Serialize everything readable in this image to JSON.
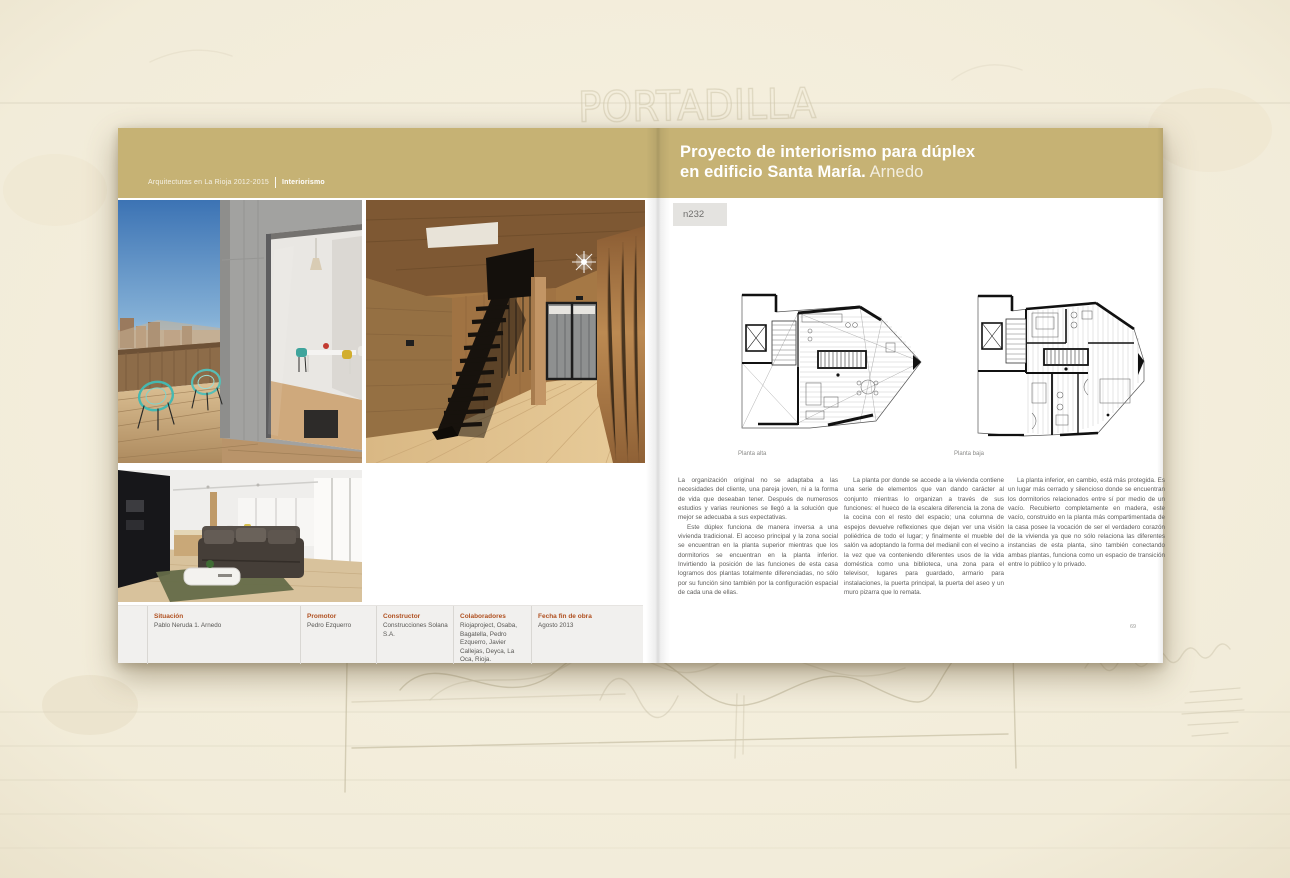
{
  "book": {
    "series_title": "Arquitecturas en La Rioja 2012-2015",
    "section": "Interiorismo",
    "project_title_line1": "Proyecto de interiorismo para dúplex",
    "project_title_line2": "en edificio Santa María.",
    "project_location": " Arnedo",
    "project_code": "n232",
    "page_number": "69"
  },
  "plans": {
    "left_caption": "Planta alta",
    "right_caption": "Planta baja"
  },
  "body": {
    "col1_p1": "La organización original no se adaptaba a las necesidades del cliente, una pareja joven, ni a la forma de vida que deseaban tener. Después de numerosos estudios y varias reuniones se llegó a la solución que mejor se adecuaba a sus expectativas.",
    "col1_p2": "Este dúplex funciona de manera inversa a una vivienda tradicional. El acceso principal y la zona social se encuentran en la planta superior mientras que los dormitorios se encuentran en la planta inferior. Invirtiendo la posición de las funciones de esta casa logramos dos plantas totalmente diferenciadas, no sólo por su función sino también por la configuración espacial de cada una de ellas.",
    "col2_p1": "La planta por donde se accede a la vivienda contiene una serie de elementos que van dando carácter al conjunto mientras lo organizan a través de sus funciones: el hueco de la escalera diferencia la zona de la cocina con el resto del espacio; una columna de espejos devuelve reflexiones que dejan ver una visión poliédrica de todo el lugar; y finalmente el mueble del salón va adoptando la forma del medianil con el vecino a la vez que va conteniendo diferentes usos de la vida doméstica como una biblioteca, una zona para el televisor, lugares para guardado, armario para instalaciones, la puerta principal, la puerta del aseo y un muro pizarra que lo remata.",
    "col3_p1": "La planta inferior, en cambio, está más protegida. Es un lugar más cerrado y silencioso donde se encuentran los dormitorios relacionados entre sí por medio de un vacío. Recubierto completamente en madera, este vacío, construido en la planta más compartimentada de la casa posee la vocación de ser el verdadero corazón de la vivienda ya que no sólo relaciona las diferentes instancias de esta planta, sino también conectando ambas plantas, funciona como un espacio de transición entre lo público y lo privado."
  },
  "metadata": {
    "items": [
      {
        "label": "Situación",
        "value": "Pablo Neruda 1. Arnedo"
      },
      {
        "label": "Promotor",
        "value": "Pedro Ezquerro"
      },
      {
        "label": "Constructor",
        "value": "Construcciones Solana S.A."
      },
      {
        "label": "Colaboradores",
        "value": "Riojaproject, Osaba, Bagatella, Pedro Ezquerro, Javier Callejas, Deyca, La Oca, Rioja."
      },
      {
        "label": "Fecha fin de obra",
        "value": "Agosto 2013"
      }
    ]
  },
  "sketch": {
    "watermark": "PORTADILLA"
  },
  "colors": {
    "band_gold": "#c6b274",
    "label_accent": "#b05020",
    "paper": "#f3eedd",
    "body_text": "#5e5d5b"
  }
}
